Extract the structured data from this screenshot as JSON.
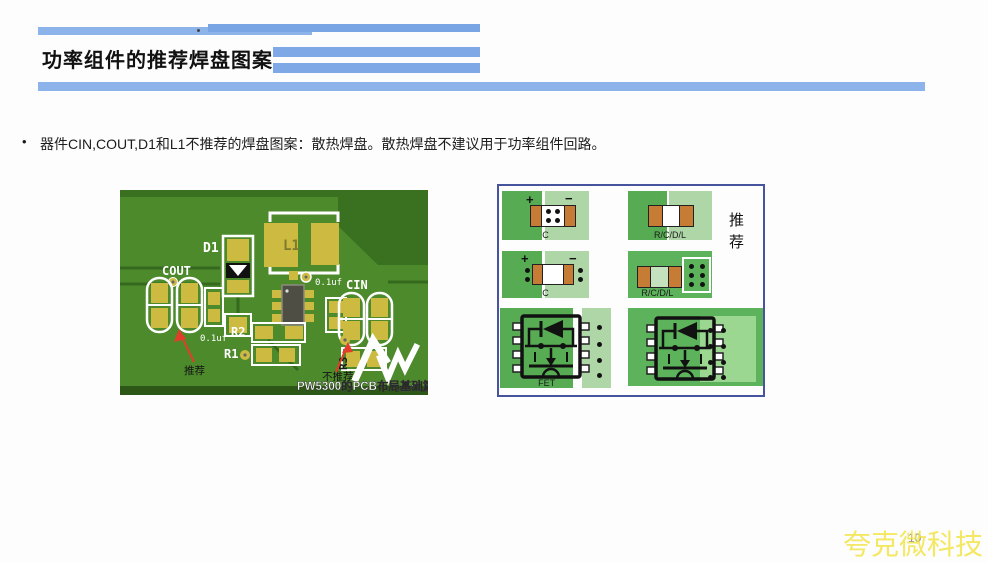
{
  "slide": {
    "title": "功率组件的推荐焊盘图案",
    "bullet_marker": "•",
    "bullet_text": "器件CIN,COUT,D1和L1不推荐的焊盘图案：散热焊盘。散热焊盘不建议用于功率组件回路。",
    "page_number": "10",
    "watermark": "夸克微科技",
    "accent_blue": "#84ace7"
  },
  "pcb": {
    "caption": "PW5300的PCB布局基础篇",
    "labels": {
      "d1": "D1",
      "l1": "L1",
      "cout": "COUT",
      "cin": "CIN",
      "r1": "R1",
      "r2": "R2",
      "r3": "R3",
      "cap_left": "0.1uf",
      "cap_center": "0.1uf",
      "recommended": "推荐",
      "not_recommended": "不推荐"
    },
    "colors": {
      "board_green": "#4d8a2c",
      "board_dark_green": "#3a7120",
      "pad_yellow": "#cdbb41",
      "silkscreen": "#ffffff",
      "arrow_red": "#e23d28"
    }
  },
  "diagram": {
    "recommended_label": "推荐",
    "cells": [
      {
        "name": "cap-vias-in-pad",
        "label": "C",
        "plus": "+",
        "minus": "−"
      },
      {
        "name": "rcdl-separate-pads",
        "label": "R/C/D/L"
      },
      {
        "name": "cap-vias-beside-pad",
        "label": "C",
        "plus": "+",
        "minus": "−"
      },
      {
        "name": "rcdl-vias-beside",
        "label": "R/C/D/L"
      },
      {
        "name": "fet-vias-row",
        "label": "FET"
      },
      {
        "name": "fet-vias-grid",
        "label": ""
      }
    ],
    "colors": {
      "green_dark": "#57ab53",
      "green_light": "#aed6a6",
      "green_solid": "#5db35b",
      "pad_orange": "#c67c35",
      "border_blue": "#46549e"
    }
  }
}
